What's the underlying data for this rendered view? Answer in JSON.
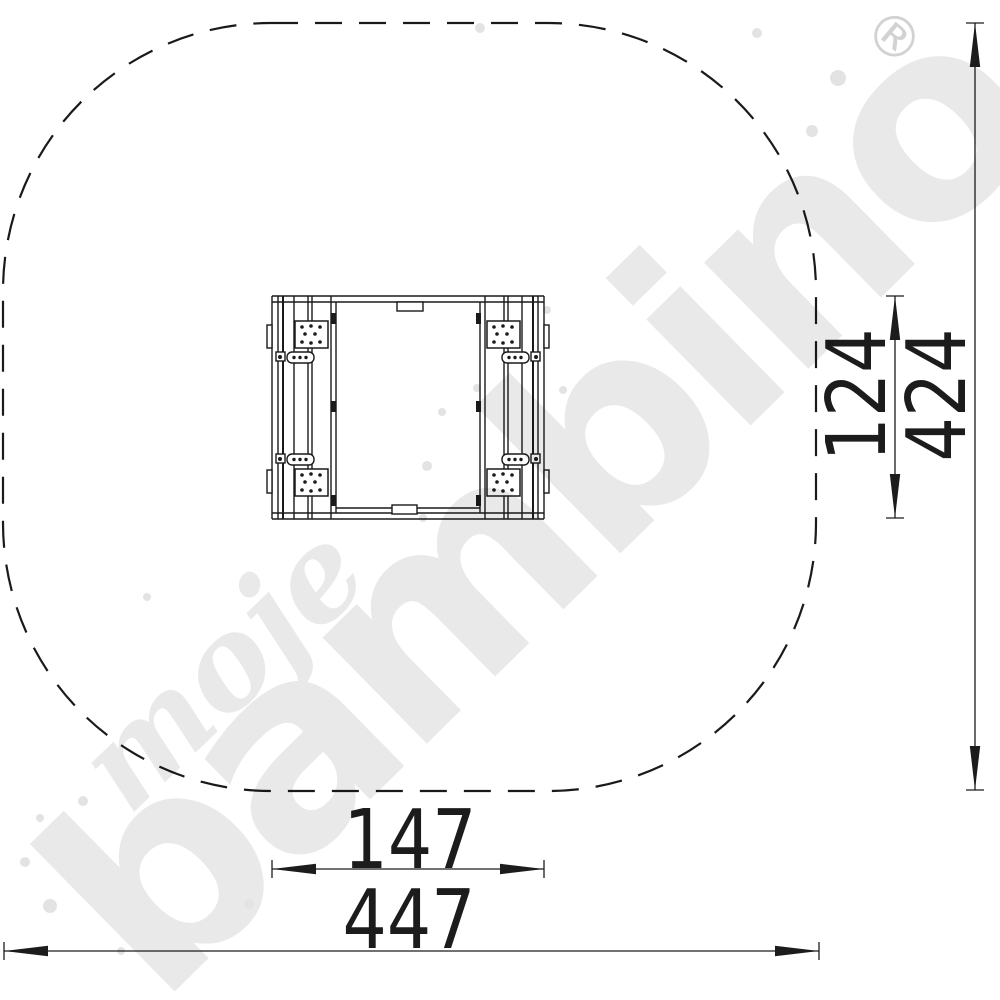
{
  "watermark": {
    "script_word": "moje",
    "brand_word": "bambino",
    "registered_mark": "®"
  },
  "dimension_labels": {
    "inner_width": "147",
    "outer_width": "447",
    "inner_depth": "124",
    "outer_depth": "424"
  },
  "colors": {
    "background": "#ffffff",
    "line": "#1a1a1a",
    "dimension_text": "#1c1c1c",
    "watermark_gray": "#e9e9e9",
    "registered_gray": "#d2d2d2",
    "speckle_gray": "#e3e3e3"
  }
}
